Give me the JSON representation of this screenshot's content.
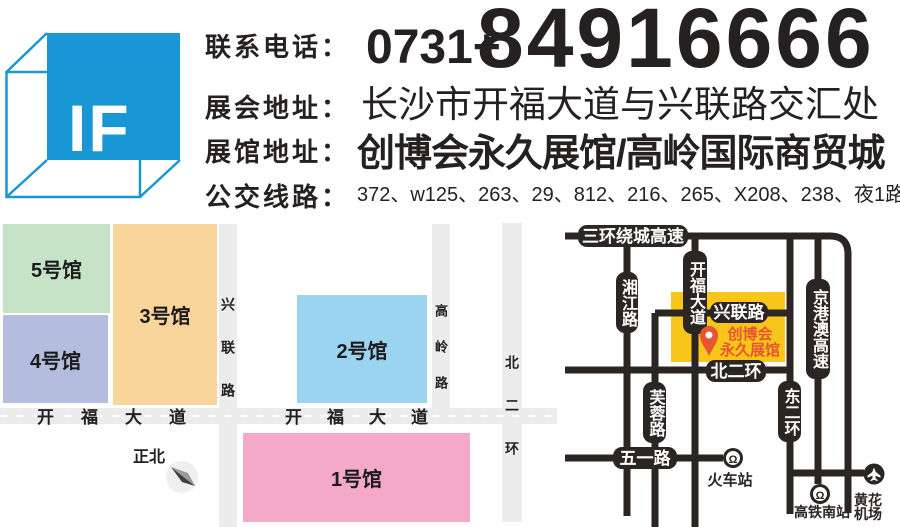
{
  "header": {
    "logo_text": "IF",
    "phone": {
      "label": "联系电话：",
      "prefix": "0731+",
      "number": "84916666"
    },
    "expo": {
      "label": "展会地址：",
      "value": "长沙市开福大道与兴联路交汇处"
    },
    "venue": {
      "label": "展馆地址：",
      "value": "创博会永久展馆/高岭国际商贸城"
    },
    "bus": {
      "label": "公交线路：",
      "value": "372、w125、263、29、812、216、265、X208、238、夜1路"
    }
  },
  "site_map": {
    "halls": [
      {
        "label": "1号馆",
        "color": "#F3A9C7"
      },
      {
        "label": "2号馆",
        "color": "#9BD4F0"
      },
      {
        "label": "3号馆",
        "color": "#F9D49B"
      },
      {
        "label": "4号馆",
        "color": "#B5BDDE"
      },
      {
        "label": "5号馆",
        "color": "#C7E3C7"
      }
    ],
    "roads": {
      "xinglian": "兴联路",
      "gaoling": "高岭路",
      "beierhuan": "北二环",
      "kaifu": "开福大道"
    },
    "north_label": "正北"
  },
  "area_map": {
    "venue": {
      "line1": "创博会",
      "line2": "永久展馆"
    },
    "roads": {
      "sanhuan": "三环绕城高速",
      "xiangjiang": "湘江路",
      "kaifu": "开福大道",
      "xinglian": "兴联路",
      "jinggangao": "京港澳高速",
      "beierhuan": "北二环",
      "furong": "芙蓉路",
      "wuyi": "五一路",
      "dongerhuan": "东二环"
    },
    "stations": {
      "railway": "火车站",
      "hsr": "高铁南站",
      "airport_line1": "黄花",
      "airport_line2": "机场"
    }
  },
  "colors": {
    "logo_blue": "#1897D4",
    "road_dark": "#2B2523",
    "road_gray": "#ECECEC",
    "venue_yellow": "#F8C51A",
    "venue_red": "#E85532"
  }
}
